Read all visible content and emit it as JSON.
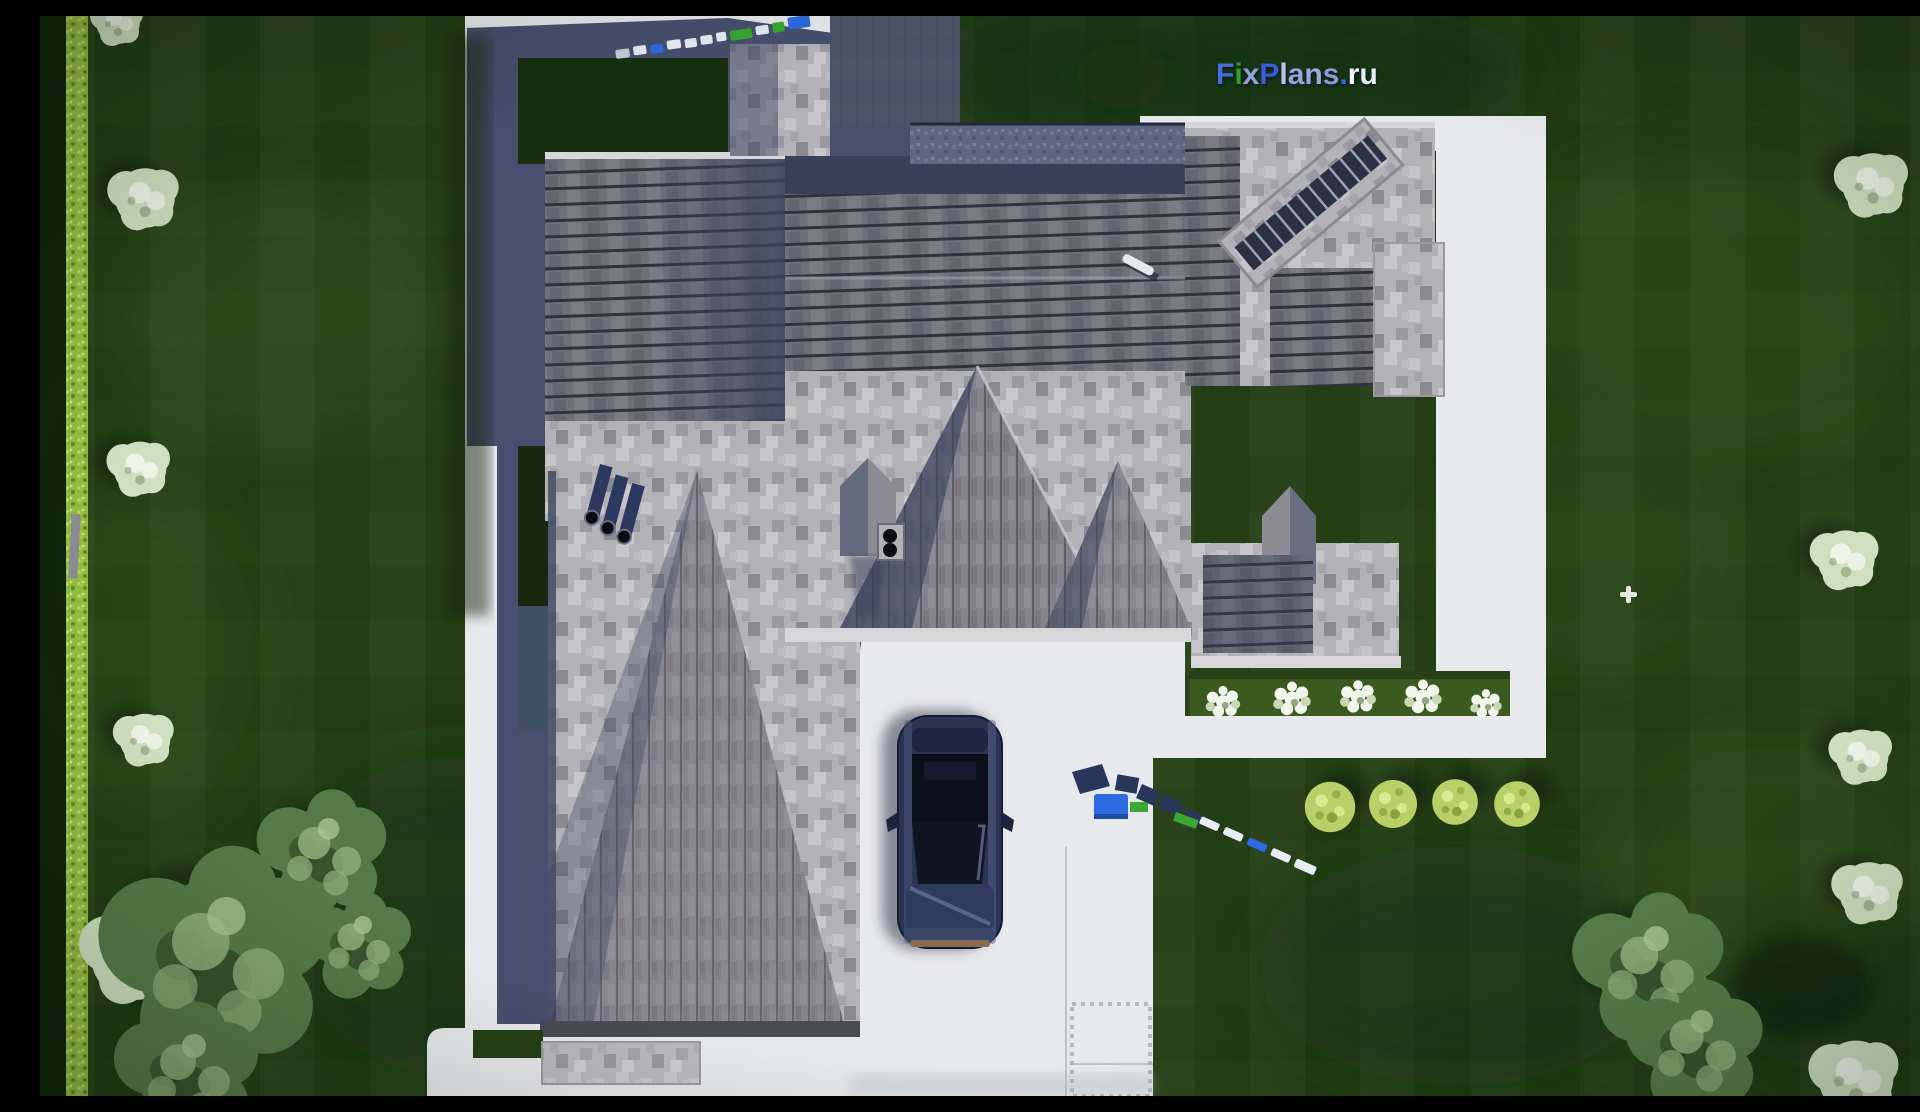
{
  "watermark": {
    "text": "FixPlans.ru",
    "letters": [
      {
        "ch": "F",
        "color": "#4a6cd8"
      },
      {
        "ch": "i",
        "color": "#2f9e33"
      },
      {
        "ch": "x",
        "color": "#93a3dd"
      },
      {
        "ch": "P",
        "color": "#3a5cd6"
      },
      {
        "ch": "l",
        "color": "#b9c2ea"
      },
      {
        "ch": "a",
        "color": "#93a3dd"
      },
      {
        "ch": "n",
        "color": "#9aa9e0"
      },
      {
        "ch": "s",
        "color": "#8b9bdb"
      },
      {
        "ch": ".",
        "color": "#2f6de0"
      },
      {
        "ch": "r",
        "color": "#f2f4f8"
      },
      {
        "ch": "u",
        "color": "#e9edf6"
      }
    ]
  },
  "scene": {
    "description": "Aerial top-down 3D render of a large suburban house with gray shingle roofs, white driveway and walkways, dark navy sedan parked on driveway, lawns with trees, hedges and flower beds",
    "objects": [
      "house-roof",
      "driveway",
      "walkway",
      "car",
      "lawn",
      "left-hedge",
      "courtyard-lawn",
      "flower-bed",
      "round-bushes",
      "trees",
      "roof-chimney-pipes",
      "skylight-ladder",
      "survey-markers",
      "watermark-logo"
    ]
  },
  "colors": {
    "pavement": "#e8e9ec",
    "pavementBright": "#f2f2f4",
    "pavementShadow": "#46506e",
    "lawn": "#27421614",
    "lawnBase": "#243f15",
    "lawnDark": "#16300f",
    "lawnLight": "#3c5c24",
    "hedge": "#96bd43",
    "hedgeDark": "#0f2409",
    "roofLight": "#b3b2b7",
    "roofSpeckleA": "#c6c5ca",
    "roofSpeckleB": "#9a99a1",
    "roofMid": "#84838c",
    "roofStripe": "#6f6f78",
    "roofLine": "#31313b",
    "roofDark": "#39415a",
    "deck": "#5d6880",
    "eave": "#d7d7da",
    "navyShadow": "#46506e",
    "wallBlock": "#414b63",
    "carBody": "#2a3556",
    "carGlass": "#0c1019",
    "carTrim": "#8a6a50",
    "bedGreen": "#3a5a20",
    "flowerWhite": "#f2f5ec",
    "bushBright": "#b9d068",
    "treeGreen": "#567a47",
    "treeLight": "#8fb07b",
    "bushPale": "#cfe0c0",
    "markerBlue": "#2e6ae0",
    "markerGreen": "#3aa832",
    "markerWhite": "#e8edf5",
    "markerNavy": "#273659"
  }
}
